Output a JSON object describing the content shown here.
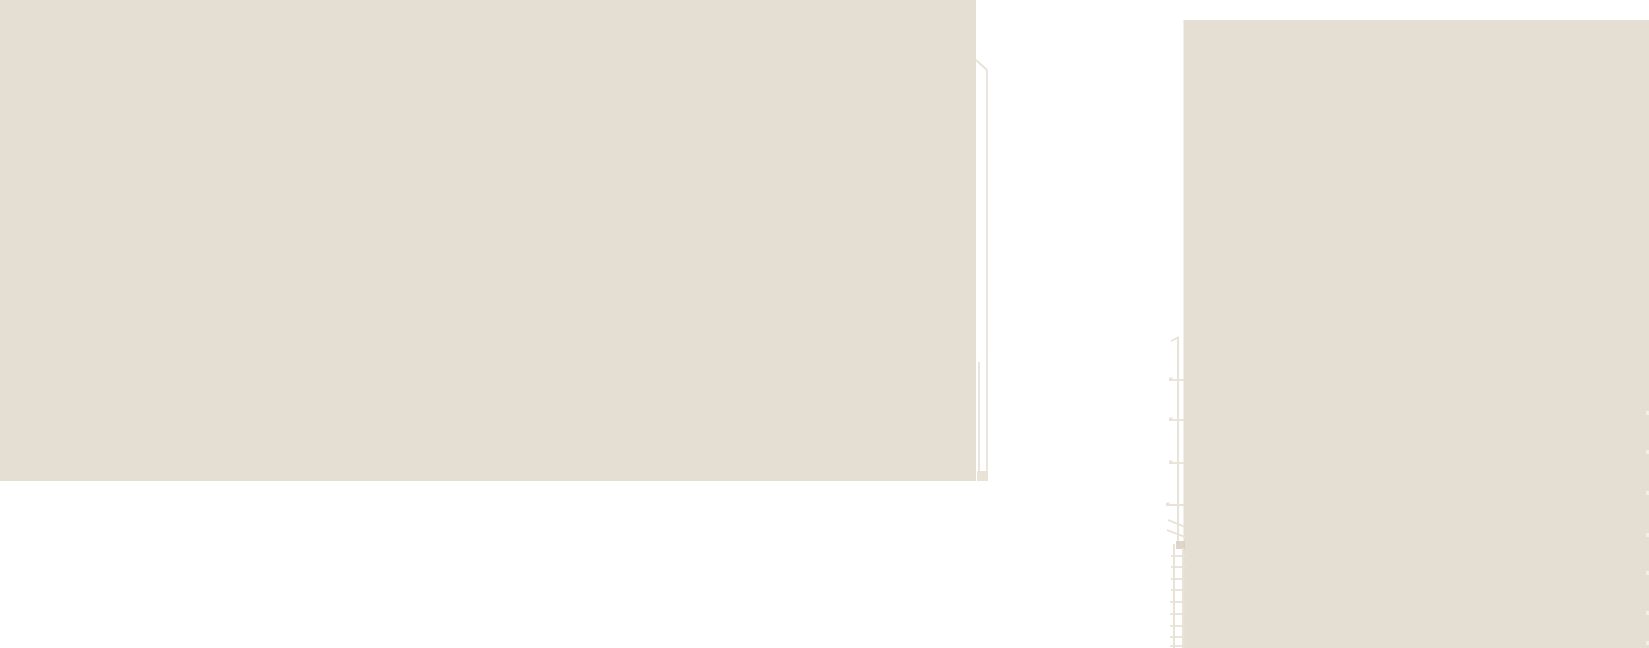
{
  "scene": {
    "type": "overexposed-minimalist-photograph",
    "description": "High-key photo of two pale beige building facades against a blown-out white sky; faint corner outline beside the left facade, faint fire-escape ladder on the left edge of the right facade, tiny light ladder ticks at the far right image edge",
    "elements": [
      "sky",
      "left-building-facade",
      "building-corner-outline",
      "right-building-facade",
      "fire-escape-ladder",
      "right-edge-ladder-ticks"
    ]
  },
  "colors": {
    "sky": "#ffffff",
    "building": "#e5ded3",
    "line": "#e9e2d6",
    "line_dark": "#d9cfc0",
    "edge_tick": "#f3eee6"
  }
}
